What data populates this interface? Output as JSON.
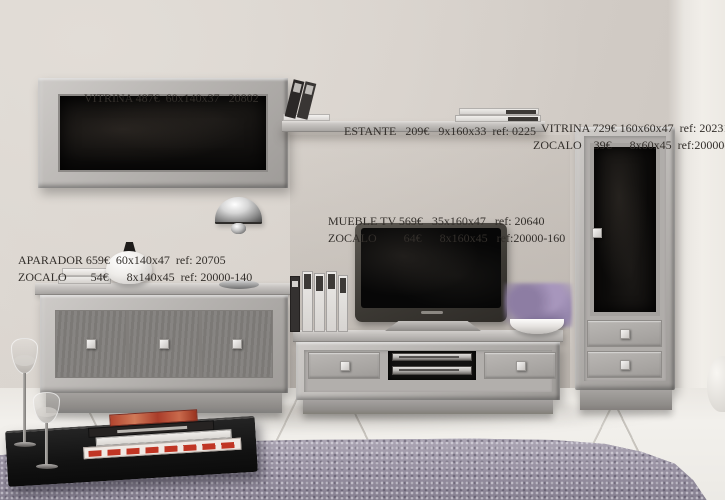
{
  "annotations": {
    "wall_vitrina": {
      "line1": "VITRINA 487€  60x140x37   20802"
    },
    "estante": {
      "line1": "ESTANTE   209€   9x160x33  ref: 0225"
    },
    "tall_vitrina": {
      "line1": "VITRINA 729€ 160x60x47  ref: 20231",
      "line2": "ZOCALO    39€      8x60x45  ref:20000-60"
    },
    "mueble_tv": {
      "line1": "MUEBLE TV 569€   35x160x47   ref: 20640",
      "line2": "ZOCALO         64€      8x160x45   ref:20000-160"
    },
    "aparador": {
      "line1": "APARADOR 659€  60x140x47  ref: 20705",
      "line2": "ZOCALO        54€      8x140x45  ref: 20000-140"
    }
  },
  "colors": {
    "wall": "#d6d0ca",
    "wall_right": "#f1eee9",
    "furniture_gray": "#b3b0ad",
    "glass_black": "#0d0c0b",
    "floor": "#f2f0ec",
    "rug_purple": "#9d97a5",
    "flowers_purple": "#8d7da3",
    "annotation_text": "#332f2b"
  }
}
